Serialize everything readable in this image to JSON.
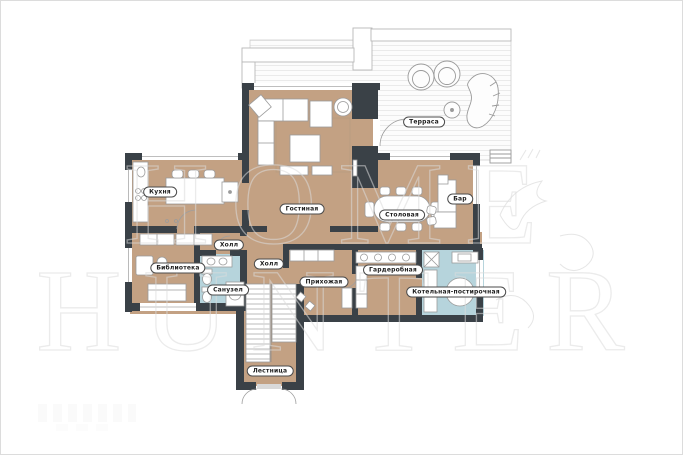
{
  "plan": {
    "title_hint": "План 1 этажа",
    "watermark": {
      "line1": "HOME",
      "line2": "HUNTER"
    },
    "colors": {
      "floor": "#c3a183",
      "wall": "#3a4147",
      "wet_room": "#b6d4dc",
      "terrace_line": "#eaeaea",
      "label_border": "#4b4b4b",
      "watermark": "#dcdcdc",
      "fixture_stroke": "#9b9b9b"
    },
    "rooms": [
      {
        "id": "kitchen",
        "label": "Кухня"
      },
      {
        "id": "living",
        "label": "Гостиная"
      },
      {
        "id": "dining",
        "label": "Столовая"
      },
      {
        "id": "bar",
        "label": "Бар"
      },
      {
        "id": "hall-small",
        "label": "Холл"
      },
      {
        "id": "hall",
        "label": "Холл"
      },
      {
        "id": "library",
        "label": "Библиотека"
      },
      {
        "id": "bathroom",
        "label": "Санузел"
      },
      {
        "id": "entry",
        "label": "Прихожая"
      },
      {
        "id": "wardrobe",
        "label": "Гардеробная"
      },
      {
        "id": "boiler",
        "label": "Котельная-постирочная"
      },
      {
        "id": "stairs",
        "label": "Лестница"
      },
      {
        "id": "terrace",
        "label": "Терраса"
      }
    ]
  }
}
